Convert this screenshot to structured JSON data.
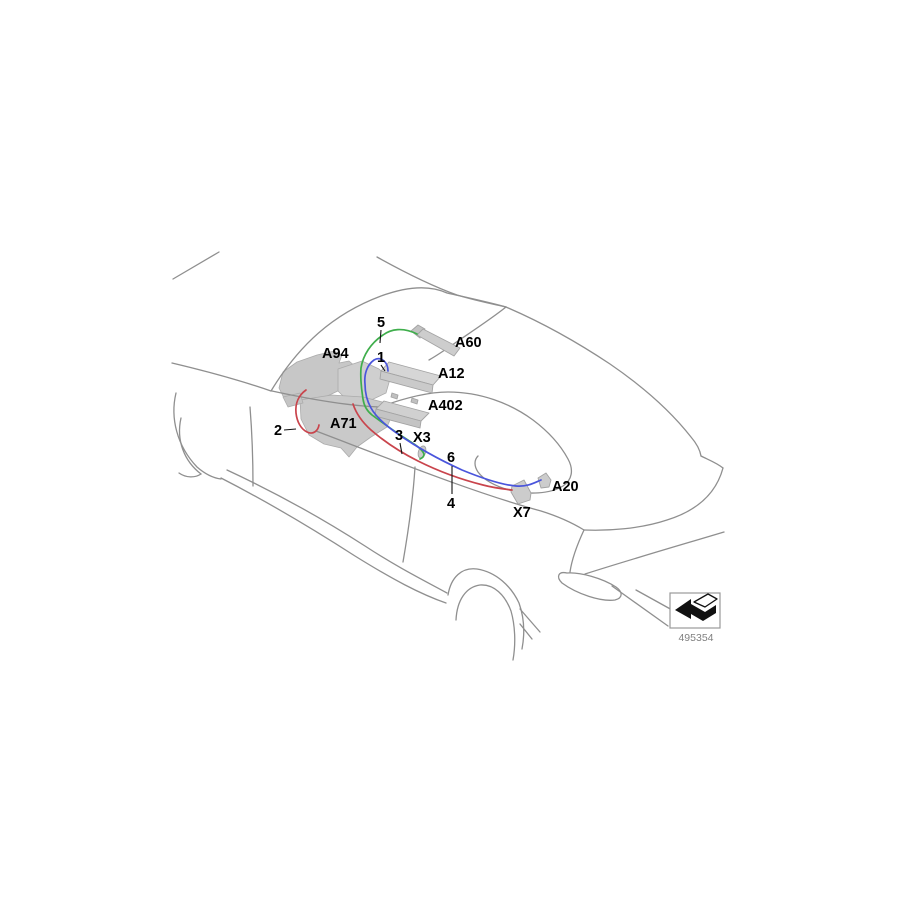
{
  "diagram": {
    "description": "Vehicle dashboard wiring harness parts diagram, isometric line-art view",
    "background_color": "#ffffff",
    "outline_color": "#8f8f8f",
    "component_fill": "#c9c9c9",
    "component_labels": {
      "a94": "A94",
      "a60": "A60",
      "a12": "A12",
      "a402": "A402",
      "a71": "A71",
      "x3": "X3",
      "x7": "X7",
      "a20": "A20"
    },
    "callouts": {
      "c1": "1",
      "c2": "2",
      "c3": "3",
      "c4": "4",
      "c5": "5",
      "c6": "6"
    },
    "wires": {
      "green": {
        "color": "#3fae4c",
        "callouts": [
          "5",
          "3"
        ]
      },
      "blue": {
        "color": "#4a55dc",
        "callouts": [
          "1",
          "6"
        ]
      },
      "red": {
        "color": "#c9444c",
        "callouts": [
          "2",
          "4"
        ]
      }
    },
    "legend": {
      "icon": "direction-arrow-icon",
      "part_number": "495354",
      "part_number_color": "#808080"
    }
  }
}
